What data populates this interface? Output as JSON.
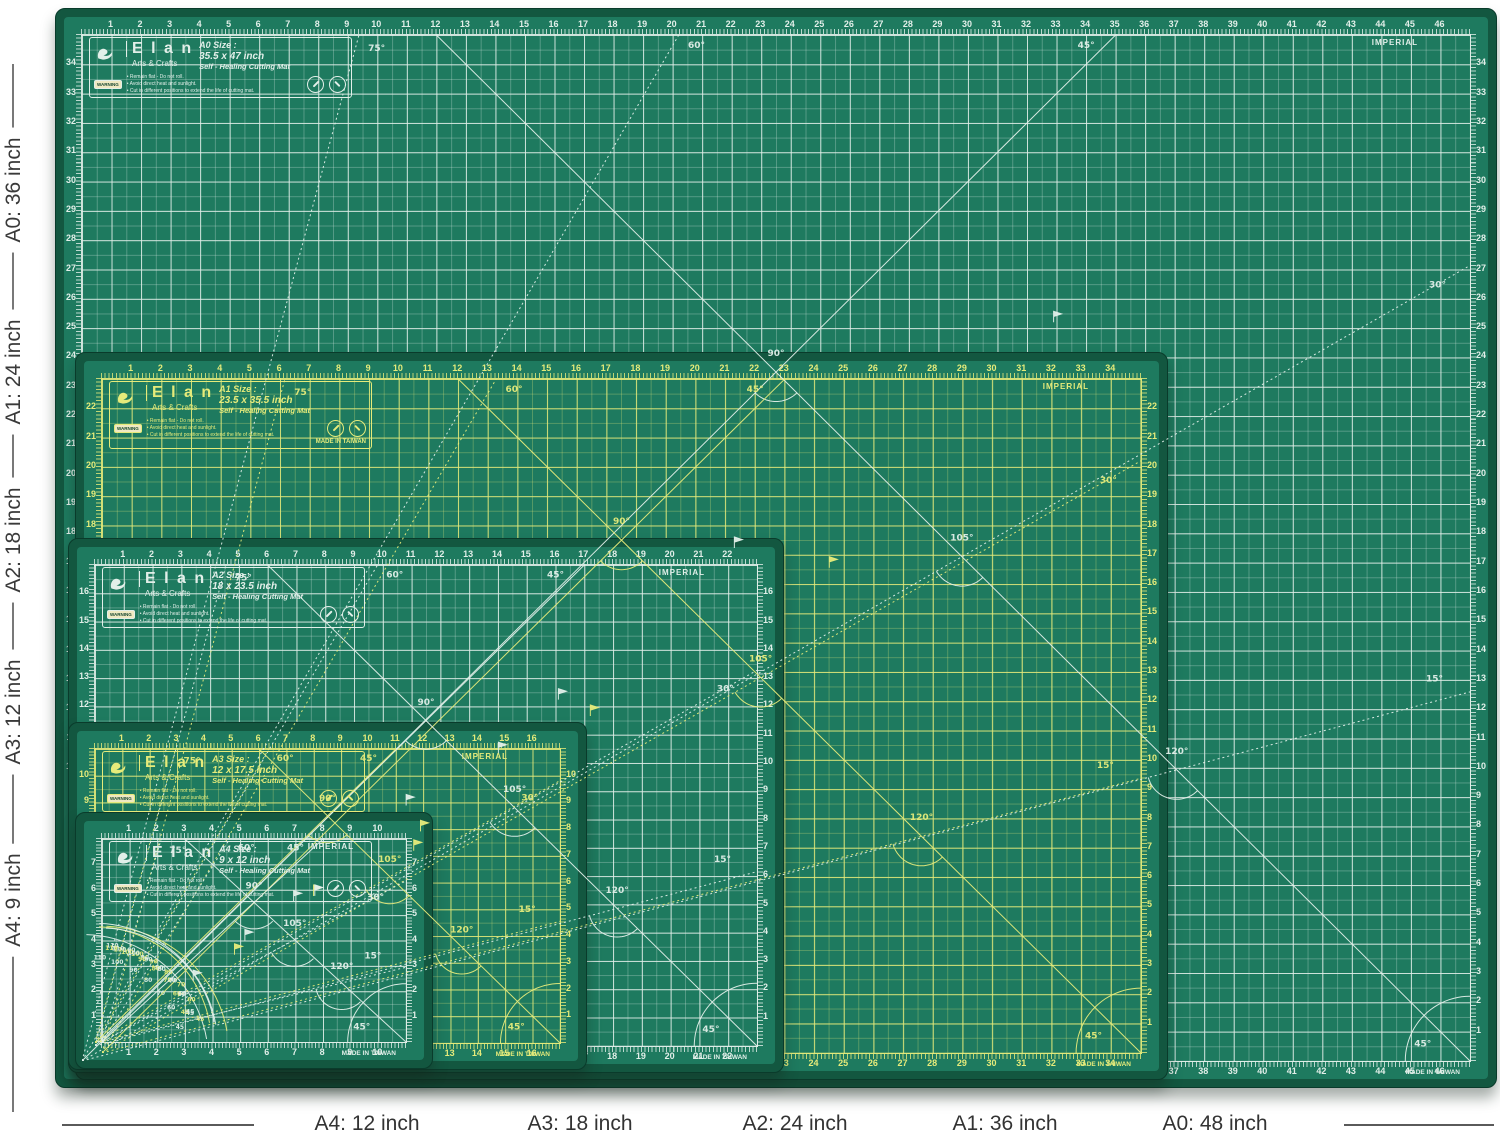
{
  "colors": {
    "mat_green": "#1e7a5f",
    "mat_rim": "#135740",
    "mat_border": "#0a3b2b",
    "grid_white": "#e2efe9",
    "grid_yellow": "#e6eb7a",
    "annotation_text": "#3a3a3a",
    "annotation_line": "#787878"
  },
  "left_labels": [
    "A0: 36 inch",
    "A1: 24 inch",
    "A2: 18 inch",
    "A3: 12 inch",
    "A4: 9 inch"
  ],
  "bottom_labels": [
    "A4: 12 inch",
    "A3: 18 inch",
    "A2: 24 inch",
    "A1: 36 inch",
    "A0: 48 inch"
  ],
  "mats": [
    {
      "id": "a0",
      "brand": "E l a n",
      "brand_sub": "Arts & Crafts",
      "size_title": "A0 Size :",
      "size_dims": "35.5 x 47 inch",
      "product": "Self - Healing Cutting Mat",
      "warning": "WARNING",
      "bullets": [
        "• Remain flat - Do not roll.",
        "• Avoid direct heat and sunlight.",
        "• Cut in different positions to extend the life of cutting mat."
      ],
      "imperial": "IMPERIAL",
      "made_in": "MADE IN TAIWAN",
      "inches_w": 47,
      "inches_h": 35,
      "grid_color": "#e2efe9",
      "angle_labels": {
        "diag": "45°",
        "steep75": "75°",
        "steep60": "60°",
        "shallow30": "30°",
        "shallow15": "15°",
        "v": "90°",
        "cross105": "105°",
        "cross120": "120°",
        "corner": "45°"
      },
      "protractor_numbers": [
        "110",
        "100",
        "90",
        "80",
        "70",
        "60",
        "45"
      ]
    },
    {
      "id": "a1",
      "brand": "E l a n",
      "brand_sub": "Arts & Crafts",
      "size_title": "A1 Size :",
      "size_dims": "23.5 x 35.5 inch",
      "product": "Self - Healing Cutting Mat",
      "warning": "WARNING",
      "bullets": [
        "• Remain flat - Do not roll.",
        "• Avoid direct heat and sunlight.",
        "• Cut in different positions to extend the life of cutting mat."
      ],
      "imperial": "IMPERIAL",
      "made_in": "MADE IN TAIWAN",
      "inches_w": 35,
      "inches_h": 23,
      "grid_color": "#e6eb7a",
      "angle_labels": {
        "diag": "45°",
        "steep75": "75°",
        "steep60": "60°",
        "shallow30": "30°",
        "shallow15": "15°",
        "v": "90°",
        "cross105": "105°",
        "cross120": "120°",
        "corner": "45°"
      },
      "protractor_numbers": [
        "110",
        "100",
        "90",
        "80",
        "70",
        "60",
        "45"
      ]
    },
    {
      "id": "a2",
      "brand": "E l a n",
      "brand_sub": "Arts & Crafts",
      "size_title": "A2 Size :",
      "size_dims": "18 x 23.5 inch",
      "product": "Self - Healing Cutting Mat",
      "warning": "WARNING",
      "bullets": [
        "• Remain flat - Do not roll.",
        "• Avoid direct heat and sunlight.",
        "• Cut in different positions to extend the life of cutting mat."
      ],
      "imperial": "IMPERIAL",
      "made_in": "MADE IN TAIWAN",
      "inches_w": 23,
      "inches_h": 17,
      "grid_color": "#e2efe9",
      "angle_labels": {
        "diag": "45°",
        "steep75": "75°",
        "steep60": "60°",
        "shallow30": "30°",
        "shallow15": "15°",
        "v": "90°",
        "cross105": "105°",
        "cross120": "120°",
        "corner": "45°"
      },
      "protractor_numbers": [
        "110",
        "100",
        "90",
        "80",
        "70",
        "60",
        "45"
      ]
    },
    {
      "id": "a3",
      "brand": "E l a n",
      "brand_sub": "Arts & Crafts",
      "size_title": "A3 Size :",
      "size_dims": "12 x 17.5 inch",
      "product": "Self - Healing Cutting Mat",
      "warning": "WARNING",
      "bullets": [
        "• Remain flat - Do not roll.",
        "• Avoid direct heat and sunlight.",
        "• Cut in different positions to extend the life of cutting mat."
      ],
      "imperial": "IMPERIAL",
      "made_in": "MADE IN TAIWAN",
      "inches_w": 17,
      "inches_h": 11,
      "grid_color": "#e6eb7a",
      "angle_labels": {
        "diag": "45°",
        "steep75": "75°",
        "steep60": "60°",
        "shallow30": "30°",
        "shallow15": "15°",
        "v": "90°",
        "cross105": "105°",
        "cross120": "120°",
        "corner": "45°"
      },
      "protractor_numbers": [
        "110",
        "100",
        "90",
        "80",
        "70",
        "60",
        "45"
      ]
    },
    {
      "id": "a4",
      "brand": "E l a n",
      "brand_sub": "Arts & Crafts",
      "size_title": "A4 Size :",
      "size_dims": "9 x 12 inch",
      "product": "Self - Healing Cutting Mat",
      "warning": "WARNING",
      "bullets": [
        "• Remain flat - Do not roll.",
        "• Avoid direct heat and sunlight.",
        "• Cut in different positions to extend the life of cutting mat."
      ],
      "imperial": "IMPERIAL",
      "made_in": "MADE IN TAIWAN",
      "inches_w": 11,
      "inches_h": 8,
      "grid_color": "#e2efe9",
      "angle_labels": {
        "diag": "45°",
        "steep75": "75°",
        "steep60": "60°",
        "shallow30": "30°",
        "shallow15": "15°",
        "v": "90°",
        "cross105": "105°",
        "cross120": "120°",
        "corner": "45°"
      },
      "protractor_numbers": [
        "110",
        "100",
        "90",
        "80",
        "70",
        "60",
        "45"
      ]
    }
  ]
}
